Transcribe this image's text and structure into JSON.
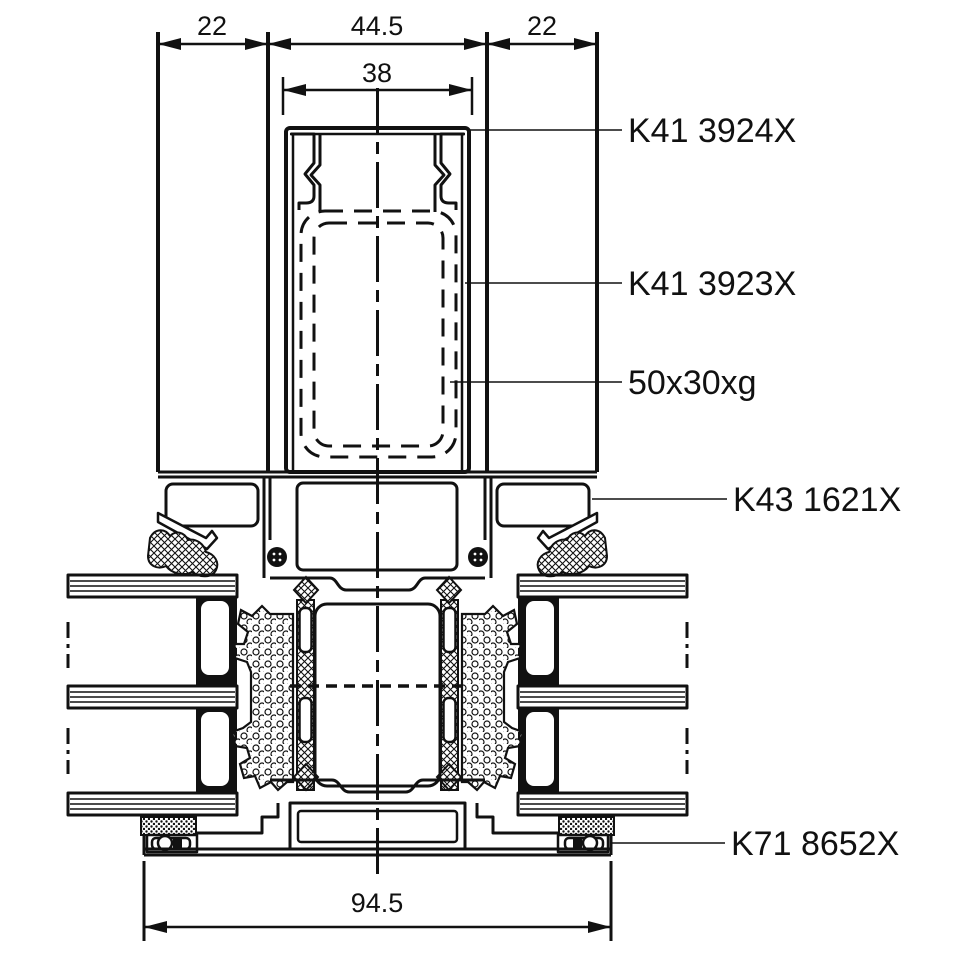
{
  "canvas": {
    "background": "#ffffff",
    "ink": "#111111"
  },
  "diagram": {
    "type": "aluminium-facade-mullion-transom-cross-section",
    "dims": {
      "glass_left": "22",
      "mullion_width": "44.5",
      "glass_right": "22",
      "cap_inner_width": "38",
      "frame_overall_width": "94.5"
    },
    "labels": {
      "cap_profile": "K41 3924X",
      "glazing_bead_profile": "K41 3923X",
      "steel_reinforcement": "50x30xg",
      "transom_profile": "K43 1621X",
      "glazing_gasket": "K71 8652X"
    }
  }
}
